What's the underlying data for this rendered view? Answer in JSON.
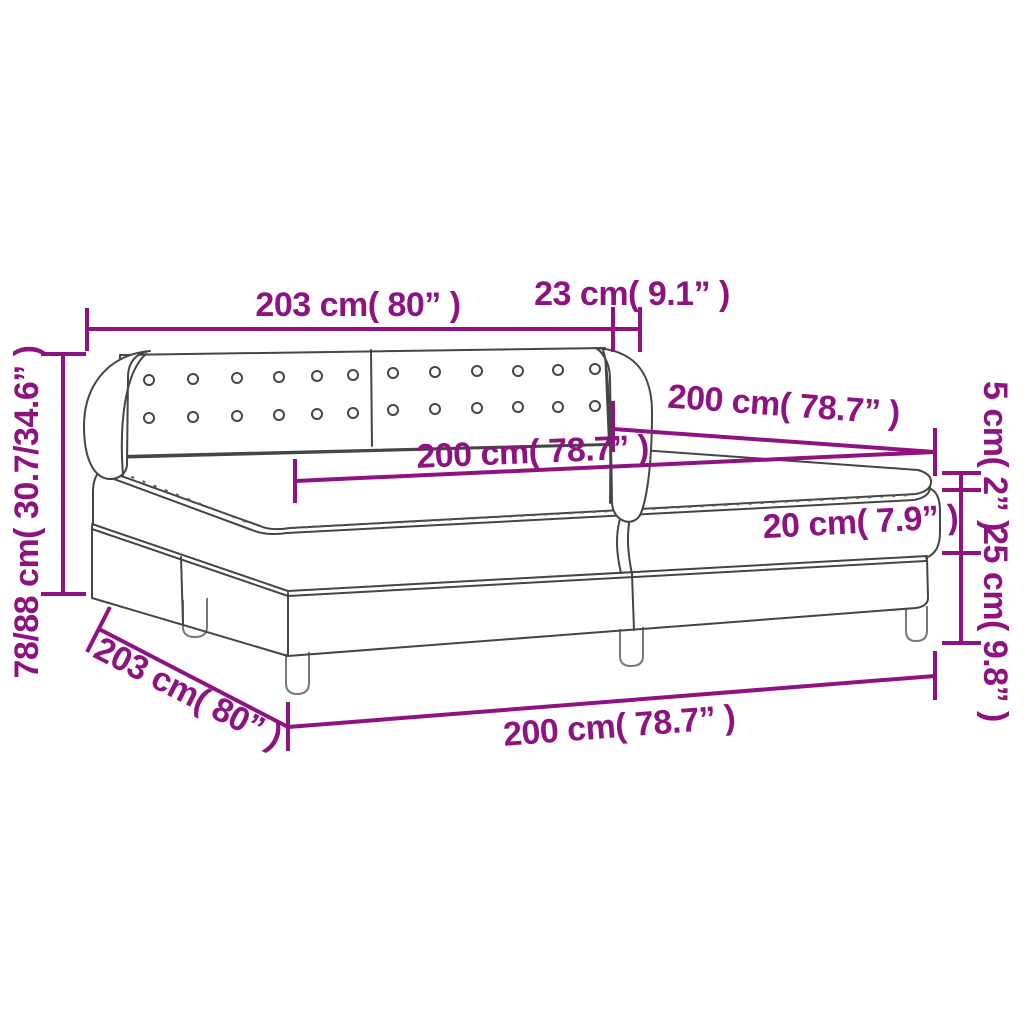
{
  "figure": {
    "type": "product-dimension-diagram",
    "subject": "box spring bed with tufted headboard"
  },
  "colors": {
    "accent": "#8E1380",
    "drawing_line": "#454545",
    "background": "#FFFFFF"
  },
  "labels": {
    "headboard_width": "203 cm( 80” )",
    "wing_depth": "23 cm( 9.1” )",
    "bed_length_top": "200 cm( 78.7” )",
    "mattress_length": "200 cm( 78.7” )",
    "topper_thickness": "5 cm( 2” )",
    "mattress_thickness": "20 cm( 7.9” )",
    "base_height": "25 cm( 9.8” )",
    "total_height": "78/88 cm( 30.7/34.6” )",
    "base_width_bottom": "203 cm( 80” )",
    "base_length_bottom": "200 cm( 78.7” )"
  }
}
